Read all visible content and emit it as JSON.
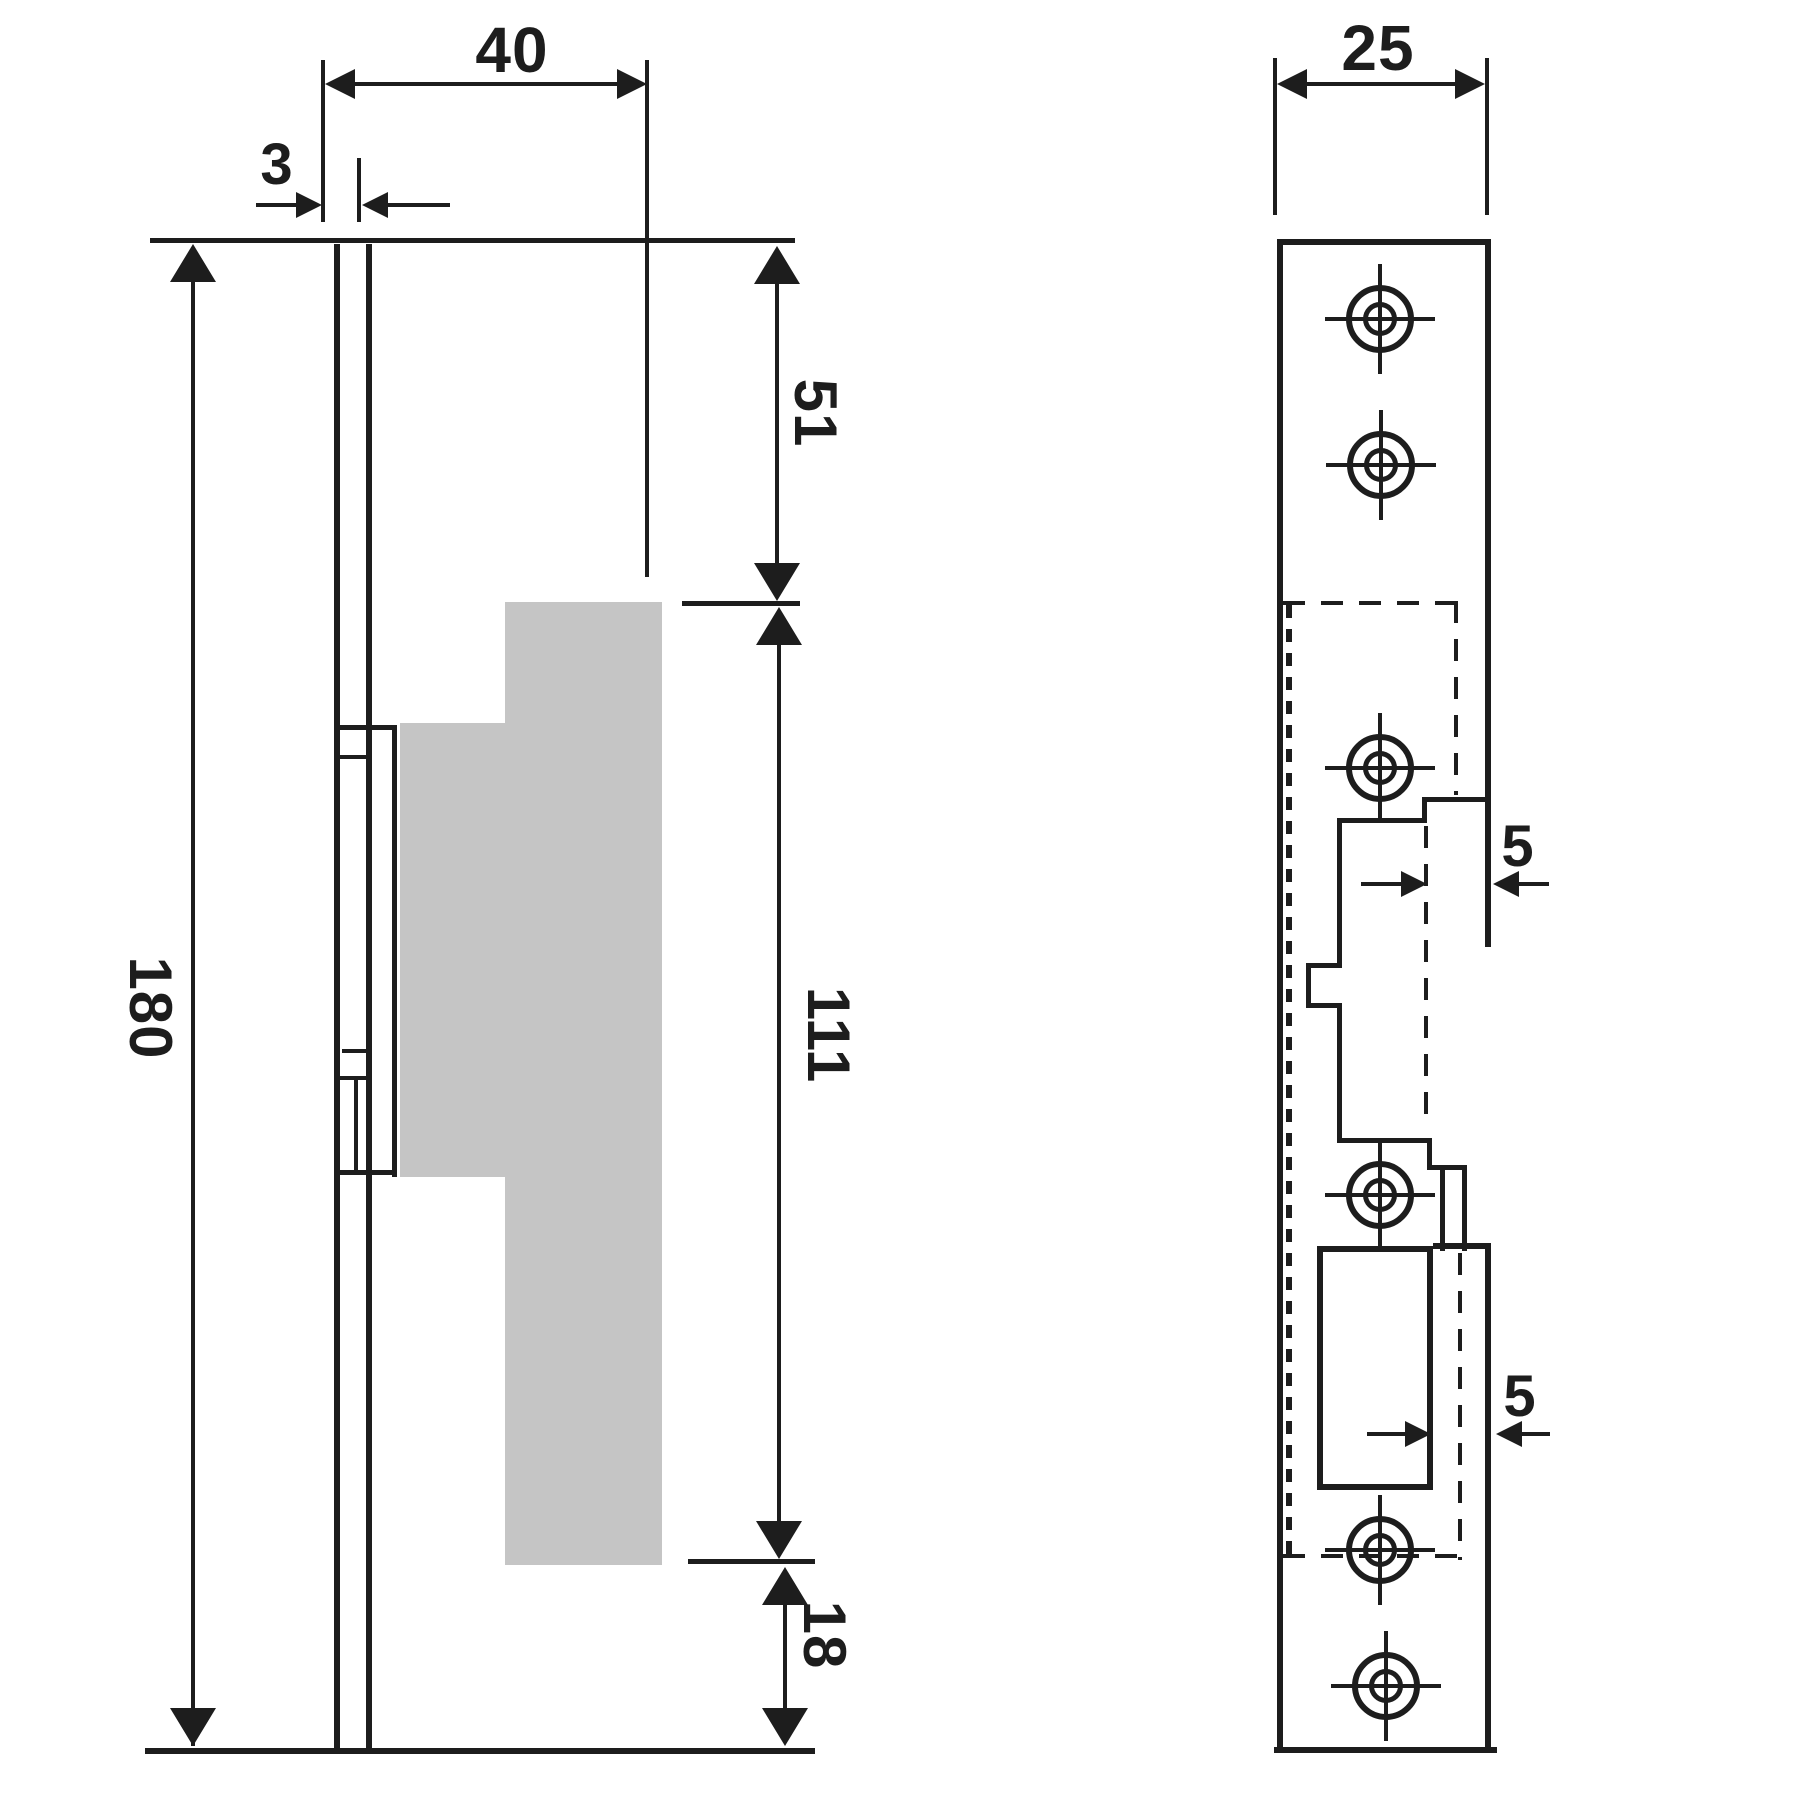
{
  "drawing": {
    "type": "technical-drawing",
    "subject": "electric door strike plate, two orthographic views",
    "colors": {
      "line": "#1d1d1d",
      "gray_fill": "#c5c5c5",
      "background": "#ffffff"
    },
    "side_view": {
      "name": "side view",
      "dim_width": "40",
      "dim_plate_thickness": "3",
      "dim_top_offset": "51",
      "dim_body_height": "111",
      "dim_bottom_offset": "18",
      "dim_total_height": "180"
    },
    "front_view": {
      "name": "front view",
      "dim_width": "25",
      "dim_lip_upper": "5",
      "dim_lip_lower": "5",
      "screw_hole_count": 6
    }
  }
}
